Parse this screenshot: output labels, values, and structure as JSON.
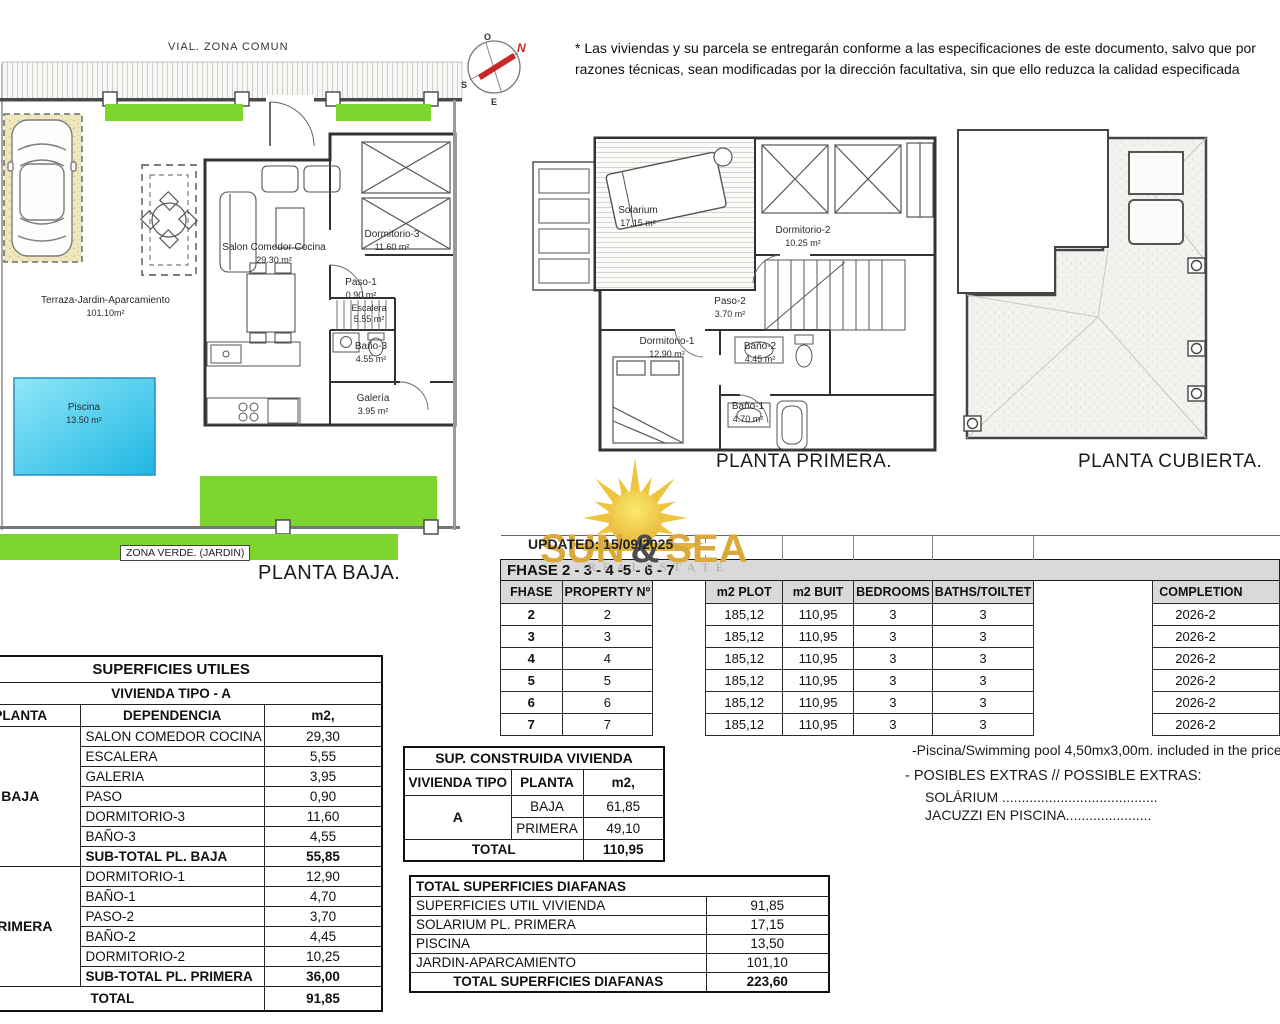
{
  "disclaimer": {
    "line1": "* Las viviendas y su parcela se entregarán conforme a las especificaciones de este documento, salvo que por",
    "line2": "razones técnicas, sean modificadas por la dirección facultativa, sin que ello reduzca la calidad especificada"
  },
  "compass": {
    "n": "N",
    "s": "S",
    "e": "E",
    "o": "O"
  },
  "planta_baja": {
    "title": "PLANTA BAJA.",
    "vial_label": "VIAL. ZONA COMUN",
    "zona_verde_label": "ZONA VERDE. (JARDIN)",
    "terraza_name": "Terraza-Jardin-Aparcamiento",
    "terraza_area": "101.10m²",
    "piscina_name": "Piscina",
    "piscina_area": "13.50 m²",
    "salon_name": "Salon Comedor Cocina",
    "salon_area": "29.30 m²",
    "dorm3_name": "Dormitorio-3",
    "dorm3_area": "11.60 m²",
    "paso1_name": "Paso-1",
    "paso1_area": "0.90 m²",
    "escalera_name": "Escalera",
    "escalera_area": "5.55 m²",
    "bano3_name": "Baño-3",
    "bano3_area": "4.55 m²",
    "galeria_name": "Galería",
    "galeria_area": "3.95 m²"
  },
  "planta_primera": {
    "title": "PLANTA PRIMERA.",
    "solarium_name": "Solarium",
    "solarium_area": "17.15 m²",
    "dorm2_name": "Dormitorio-2",
    "dorm2_area": "10.25 m²",
    "paso2_name": "Paso-2",
    "paso2_area": "3.70 m²",
    "dorm1_name": "Dormitorio-1",
    "dorm1_area": "12.90 m²",
    "bano2_name": "Baño-2",
    "bano2_area": "4.45 m²",
    "bano1_name": "Baño-1",
    "bano1_area": "4.70 m²"
  },
  "planta_cubierta": {
    "title": "PLANTA CUBIERTA."
  },
  "logo": {
    "sun": "SUN",
    "amp": "&",
    "sea": "SEA",
    "subtitle": "R E A L   E S T A T E"
  },
  "updated": "UPDATED: 15/09/2025",
  "phase_table": {
    "band": "FHASE  2 - 3 - 4 -5 - 6 - 7",
    "h_fhase": "FHASE",
    "h_property": "PROPERTY Nº",
    "h_plot": "m2 PLOT",
    "h_built": "m2 BUIT",
    "h_bedrooms": "BEDROOMS",
    "h_baths": "BATHS/TOILTET",
    "h_completion": "COMPLETION",
    "rows": [
      {
        "fhase": "2",
        "property": "2",
        "plot": "185,12",
        "built": "110,95",
        "bedrooms": "3",
        "baths": "3",
        "completion": "2026-2"
      },
      {
        "fhase": "3",
        "property": "3",
        "plot": "185,12",
        "built": "110,95",
        "bedrooms": "3",
        "baths": "3",
        "completion": "2026-2"
      },
      {
        "fhase": "4",
        "property": "4",
        "plot": "185,12",
        "built": "110,95",
        "bedrooms": "3",
        "baths": "3",
        "completion": "2026-2"
      },
      {
        "fhase": "5",
        "property": "5",
        "plot": "185,12",
        "built": "110,95",
        "bedrooms": "3",
        "baths": "3",
        "completion": "2026-2"
      },
      {
        "fhase": "6",
        "property": "6",
        "plot": "185,12",
        "built": "110,95",
        "bedrooms": "3",
        "baths": "3",
        "completion": "2026-2"
      },
      {
        "fhase": "7",
        "property": "7",
        "plot": "185,12",
        "built": "110,95",
        "bedrooms": "3",
        "baths": "3",
        "completion": "2026-2"
      }
    ]
  },
  "superficies": {
    "title": "SUPERFICIES UTILES",
    "subtitle": "VIVIENDA TIPO - A",
    "h_planta": "PLANTA",
    "h_dependencia": "DEPENDENCIA",
    "h_m2": "m2,",
    "baja_label": "BAJA",
    "primera_label": "PRIMERA",
    "baja_rows": [
      {
        "n": "SALON COMEDOR COCINA",
        "v": "29,30"
      },
      {
        "n": "ESCALERA",
        "v": "5,55"
      },
      {
        "n": "GALERIA",
        "v": "3,95"
      },
      {
        "n": "PASO",
        "v": "0,90"
      },
      {
        "n": "DORMITORIO-3",
        "v": "11,60"
      },
      {
        "n": "BAÑO-3",
        "v": "4,55"
      }
    ],
    "baja_subtotal": {
      "n": "SUB-TOTAL PL. BAJA",
      "v": "55,85"
    },
    "primera_rows": [
      {
        "n": "DORMITORIO-1",
        "v": "12,90"
      },
      {
        "n": "BAÑO-1",
        "v": "4,70"
      },
      {
        "n": "PASO-2",
        "v": "3,70"
      },
      {
        "n": "BAÑO-2",
        "v": "4,45"
      },
      {
        "n": "DORMITORIO-2",
        "v": "10,25"
      }
    ],
    "primera_subtotal": {
      "n": "SUB-TOTAL PL. PRIMERA",
      "v": "36,00"
    },
    "total": {
      "n": "TOTAL",
      "v": "91,85"
    }
  },
  "construida": {
    "title": "SUP. CONSTRUIDA VIVIENDA",
    "h_tipo": "VIVIENDA TIPO",
    "h_planta": "PLANTA",
    "h_m2": "m2,",
    "tipo": "A",
    "rows": [
      {
        "n": "BAJA",
        "v": "61,85"
      },
      {
        "n": "PRIMERA",
        "v": "49,10"
      }
    ],
    "total": {
      "n": "TOTAL",
      "v": "110,95"
    }
  },
  "diafanas": {
    "title": "TOTAL SUPERFICIES DIAFANAS",
    "rows": [
      {
        "n": "SUPERFICIES UTIL VIVIENDA",
        "v": "91,85"
      },
      {
        "n": "SOLARIUM PL. PRIMERA",
        "v": "17,15"
      },
      {
        "n": "PISCINA",
        "v": "13,50"
      },
      {
        "n": "JARDIN-APARCAMIENTO",
        "v": "101,10"
      }
    ],
    "total": {
      "n": "TOTAL SUPERFICIES DIAFANAS",
      "v": "223,60"
    }
  },
  "notes": {
    "line1": "-Piscina/Swimming pool 4,50mx3,00m. included in the price",
    "line2": "- POSIBLES EXTRAS // POSSIBLE EXTRAS:",
    "line3": "SOLÁRIUM ........................................",
    "line4": "JACUZZI EN PISCINA......................"
  },
  "colors": {
    "green": "#7CD62F",
    "pool": "#35C6EC",
    "gold": "#D9A93B",
    "header_gray": "#D9D9D9"
  }
}
